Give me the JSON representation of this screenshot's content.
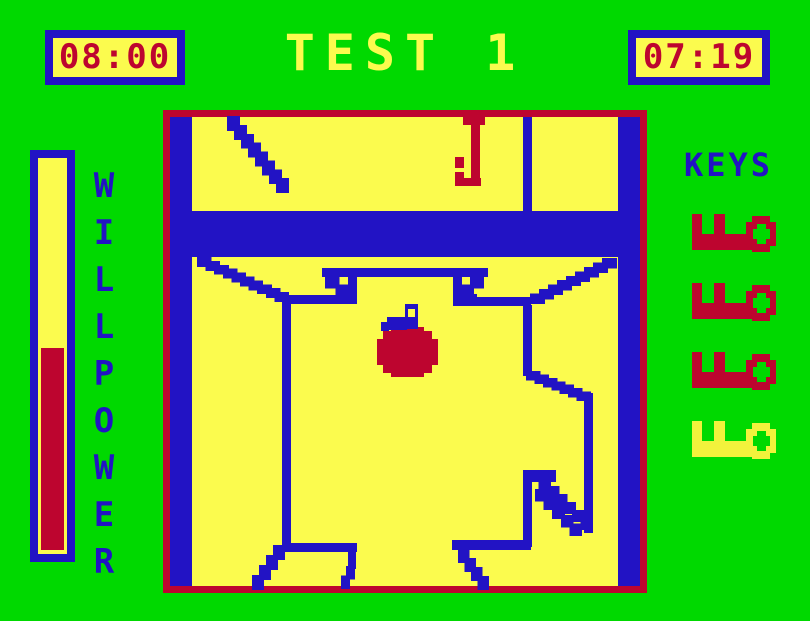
{
  "palette": {
    "green": "#00d900",
    "yellow": "#fbfb4e",
    "blue": "#2213c4",
    "red": "#bd052f"
  },
  "header": {
    "timer_left": "08:00",
    "title": "TEST 1",
    "timer_right": "07:19"
  },
  "willpower": {
    "label": "WILLPOWER",
    "fill_percent": 51,
    "fill_color": "#bd052f"
  },
  "keys": {
    "label": "KEYS",
    "items": [
      {
        "name": "key-1",
        "color": "#bd052f"
      },
      {
        "name": "key-2",
        "color": "#bd052f"
      },
      {
        "name": "key-3",
        "color": "#bd052f"
      },
      {
        "name": "key-4",
        "color": "#f2f23c"
      }
    ]
  },
  "maze": {
    "origin": {
      "x": 163,
      "y": 110
    },
    "width": 484,
    "height": 483,
    "border_color": "#bd052f",
    "background": "#fbfb4e",
    "wall_color": "#2213c4",
    "walls": [
      {
        "x": 170,
        "y": 117,
        "w": 22,
        "h": 469
      },
      {
        "x": 618,
        "y": 117,
        "w": 22,
        "h": 469
      },
      {
        "x": 192,
        "y": 211,
        "w": 426,
        "h": 46
      },
      {
        "x": 523,
        "y": 117,
        "w": 9,
        "h": 94
      },
      {
        "x": 283,
        "y": 295,
        "w": 74,
        "h": 9
      },
      {
        "x": 282,
        "y": 295,
        "w": 9,
        "h": 252
      },
      {
        "x": 322,
        "y": 268,
        "w": 166,
        "h": 9
      },
      {
        "x": 348,
        "y": 276,
        "w": 9,
        "h": 28
      },
      {
        "x": 453,
        "y": 276,
        "w": 9,
        "h": 28
      },
      {
        "x": 462,
        "y": 294,
        "w": 15,
        "h": 9
      },
      {
        "x": 453,
        "y": 297,
        "w": 78,
        "h": 9
      },
      {
        "x": 523,
        "y": 305,
        "w": 9,
        "h": 71
      },
      {
        "x": 584,
        "y": 393,
        "w": 9,
        "h": 140
      },
      {
        "x": 523,
        "y": 470,
        "w": 9,
        "h": 77
      },
      {
        "x": 523,
        "y": 470,
        "w": 33,
        "h": 12
      },
      {
        "x": 452,
        "y": 540,
        "w": 79,
        "h": 10
      },
      {
        "x": 285,
        "y": 543,
        "w": 72,
        "h": 9
      },
      {
        "x": 348,
        "y": 552,
        "w": 8,
        "h": 17
      }
    ],
    "diagonals": [
      {
        "x1": 228,
        "y1": 117,
        "x2": 284,
        "y2": 188,
        "t": 7
      },
      {
        "x1": 198,
        "y1": 258,
        "x2": 284,
        "y2": 297,
        "t": 7
      },
      {
        "x1": 326,
        "y1": 277,
        "x2": 347,
        "y2": 294,
        "t": 5
      },
      {
        "x1": 481,
        "y1": 277,
        "x2": 461,
        "y2": 294,
        "t": 5
      },
      {
        "x1": 531,
        "y1": 299,
        "x2": 612,
        "y2": 259,
        "t": 7
      },
      {
        "x1": 527,
        "y1": 372,
        "x2": 586,
        "y2": 396,
        "t": 7
      },
      {
        "x1": 531,
        "y1": 471,
        "x2": 590,
        "y2": 527,
        "t": 5
      },
      {
        "x1": 536,
        "y1": 490,
        "x2": 579,
        "y2": 533,
        "t": 5
      },
      {
        "x1": 459,
        "y1": 550,
        "x2": 485,
        "y2": 586,
        "t": 6
      },
      {
        "x1": 281,
        "y1": 546,
        "x2": 253,
        "y2": 586,
        "t": 6
      },
      {
        "x1": 352,
        "y1": 567,
        "x2": 342,
        "y2": 586,
        "t": 5
      }
    ],
    "hanging_key": {
      "color": "#bd052f",
      "rects": [
        {
          "x": 463,
          "y": 117,
          "w": 22,
          "h": 8
        },
        {
          "x": 471,
          "y": 117,
          "w": 9,
          "h": 69
        },
        {
          "x": 455,
          "y": 157,
          "w": 9,
          "h": 11
        },
        {
          "x": 455,
          "y": 172,
          "w": 9,
          "h": 14
        },
        {
          "x": 455,
          "y": 178,
          "w": 26,
          "h": 8
        }
      ]
    },
    "bomb": {
      "body_color": "#bd052f",
      "handle_color": "#2213c4",
      "hole_color": "#fbfb4e",
      "body_rects": [
        {
          "x": 377,
          "y": 339,
          "w": 61,
          "h": 26
        },
        {
          "x": 383,
          "y": 331,
          "w": 49,
          "h": 42
        },
        {
          "x": 391,
          "y": 327,
          "w": 33,
          "h": 50
        }
      ],
      "handle_rects": [
        {
          "x": 405,
          "y": 304,
          "w": 13,
          "h": 25
        },
        {
          "x": 387,
          "y": 317,
          "w": 20,
          "h": 13
        },
        {
          "x": 381,
          "y": 322,
          "w": 8,
          "h": 9
        }
      ],
      "hole_rect": {
        "x": 408,
        "y": 309,
        "w": 7,
        "h": 8
      }
    }
  }
}
